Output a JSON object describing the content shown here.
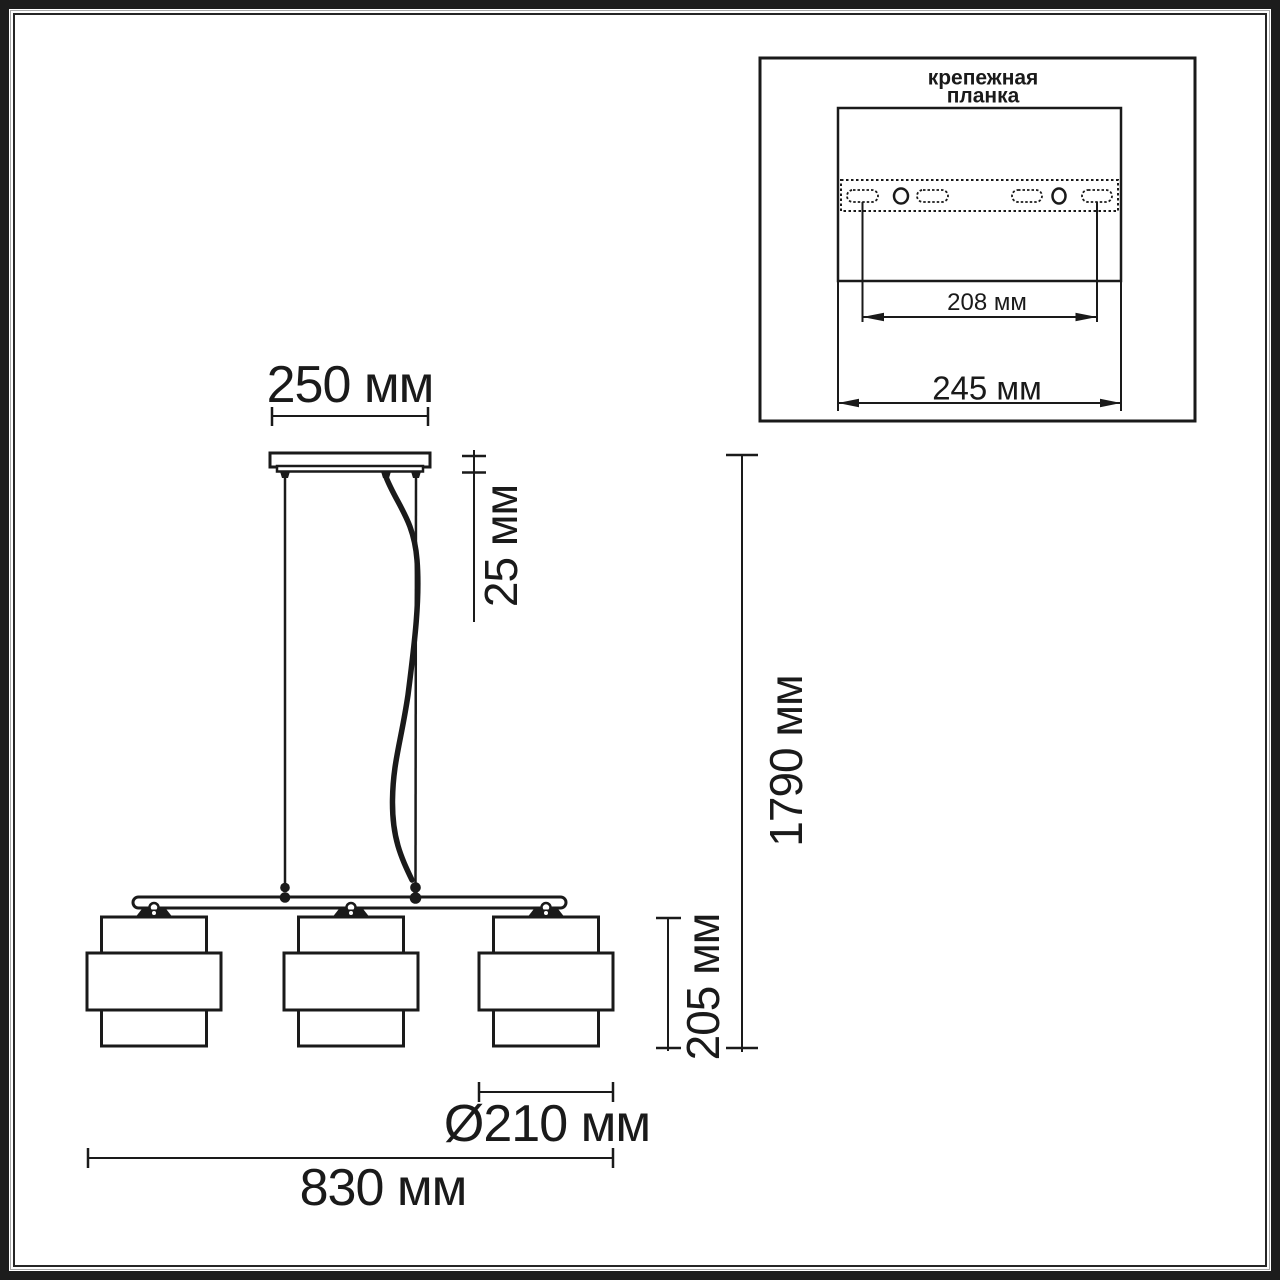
{
  "diagram": {
    "type": "pendant-lamp-dimension-drawing",
    "labels": {
      "canopy_width": "250 мм",
      "canopy_height": "25 мм",
      "total_height": "1790 мм",
      "shade_height": "205 мм",
      "shade_diameter": "Ø210 мм",
      "total_width": "830 мм"
    },
    "inset": {
      "title_line1": "крепежная",
      "title_line2": "планка",
      "hole_spacing": "208 мм",
      "plate_width": "245 мм"
    },
    "colors": {
      "line": "#1a1a1a",
      "frame": "#1c1c1c",
      "background": "#ffffff"
    }
  }
}
